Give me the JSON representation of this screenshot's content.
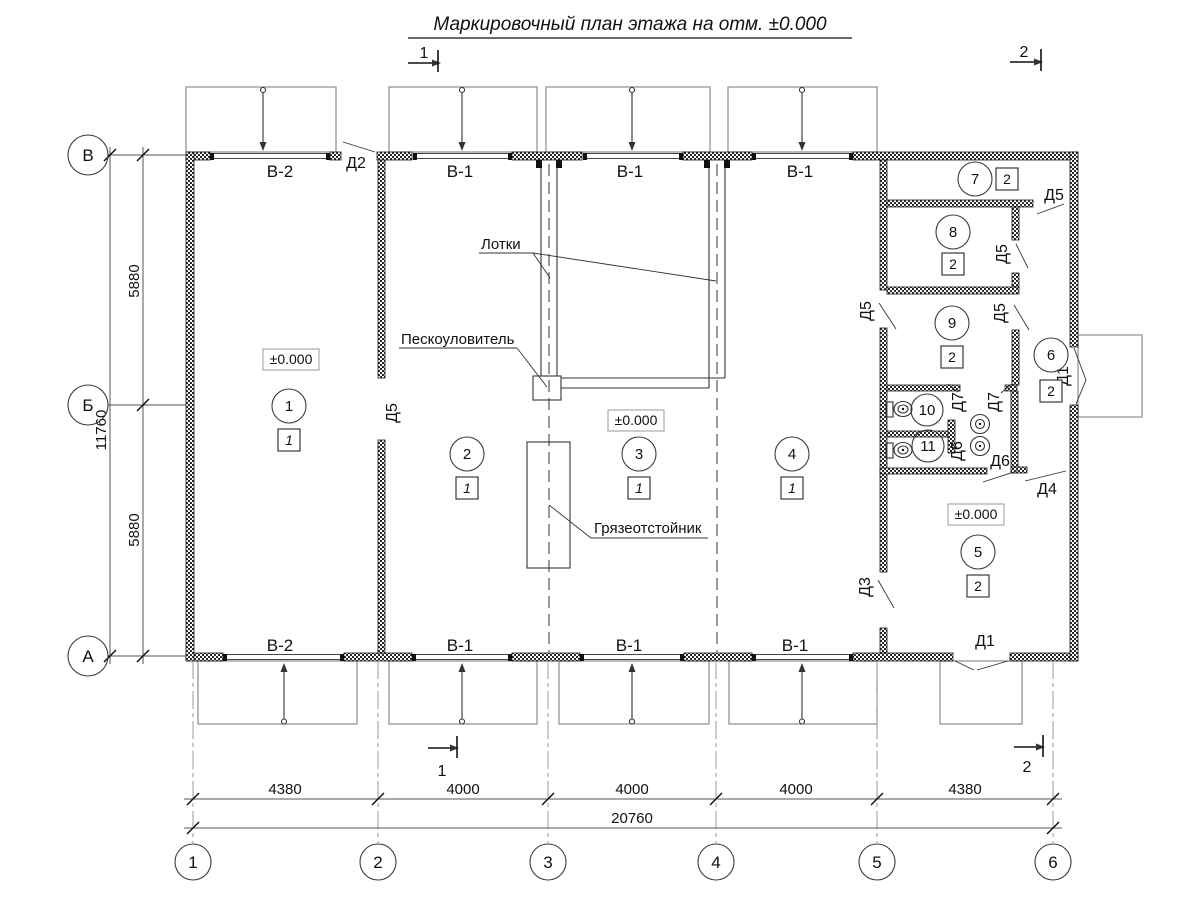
{
  "title": "Маркировочный план этажа на отм. ±0.000",
  "sections": {
    "one": "1",
    "two": "2"
  },
  "axes_bottom": [
    "1",
    "2",
    "3",
    "4",
    "5",
    "6"
  ],
  "axes_left": [
    "В",
    "Б",
    "А"
  ],
  "dims": {
    "spans": [
      "4380",
      "4000",
      "4000",
      "4000",
      "4380"
    ],
    "total": "20760",
    "left_spans": [
      "5880",
      "5880"
    ],
    "left_total": "11760"
  },
  "gates": {
    "top": [
      "В-2",
      "В-1",
      "В-1",
      "В-1"
    ],
    "bottom": [
      "В-2",
      "В-1",
      "В-1",
      "В-1"
    ]
  },
  "doors": {
    "d1": "Д1",
    "d2": "Д2",
    "d3": "Д3",
    "d4": "Д4",
    "d5": "Д5",
    "d6": "Д6",
    "d7": "Д7"
  },
  "rooms": [
    {
      "n": "1",
      "cat": "1"
    },
    {
      "n": "2",
      "cat": "1"
    },
    {
      "n": "3",
      "cat": "1"
    },
    {
      "n": "4",
      "cat": "1"
    },
    {
      "n": "5",
      "cat": "2"
    },
    {
      "n": "6",
      "cat": "2"
    },
    {
      "n": "7",
      "cat": "2"
    },
    {
      "n": "8",
      "cat": "2"
    },
    {
      "n": "9",
      "cat": "2"
    },
    {
      "n": "10"
    },
    {
      "n": "11"
    }
  ],
  "elevation_mark": "±0.000",
  "annotations": {
    "trays": "Лотки",
    "sand_trap": "Пескоуловитель",
    "mud_trap": "Грязеотстойник"
  }
}
